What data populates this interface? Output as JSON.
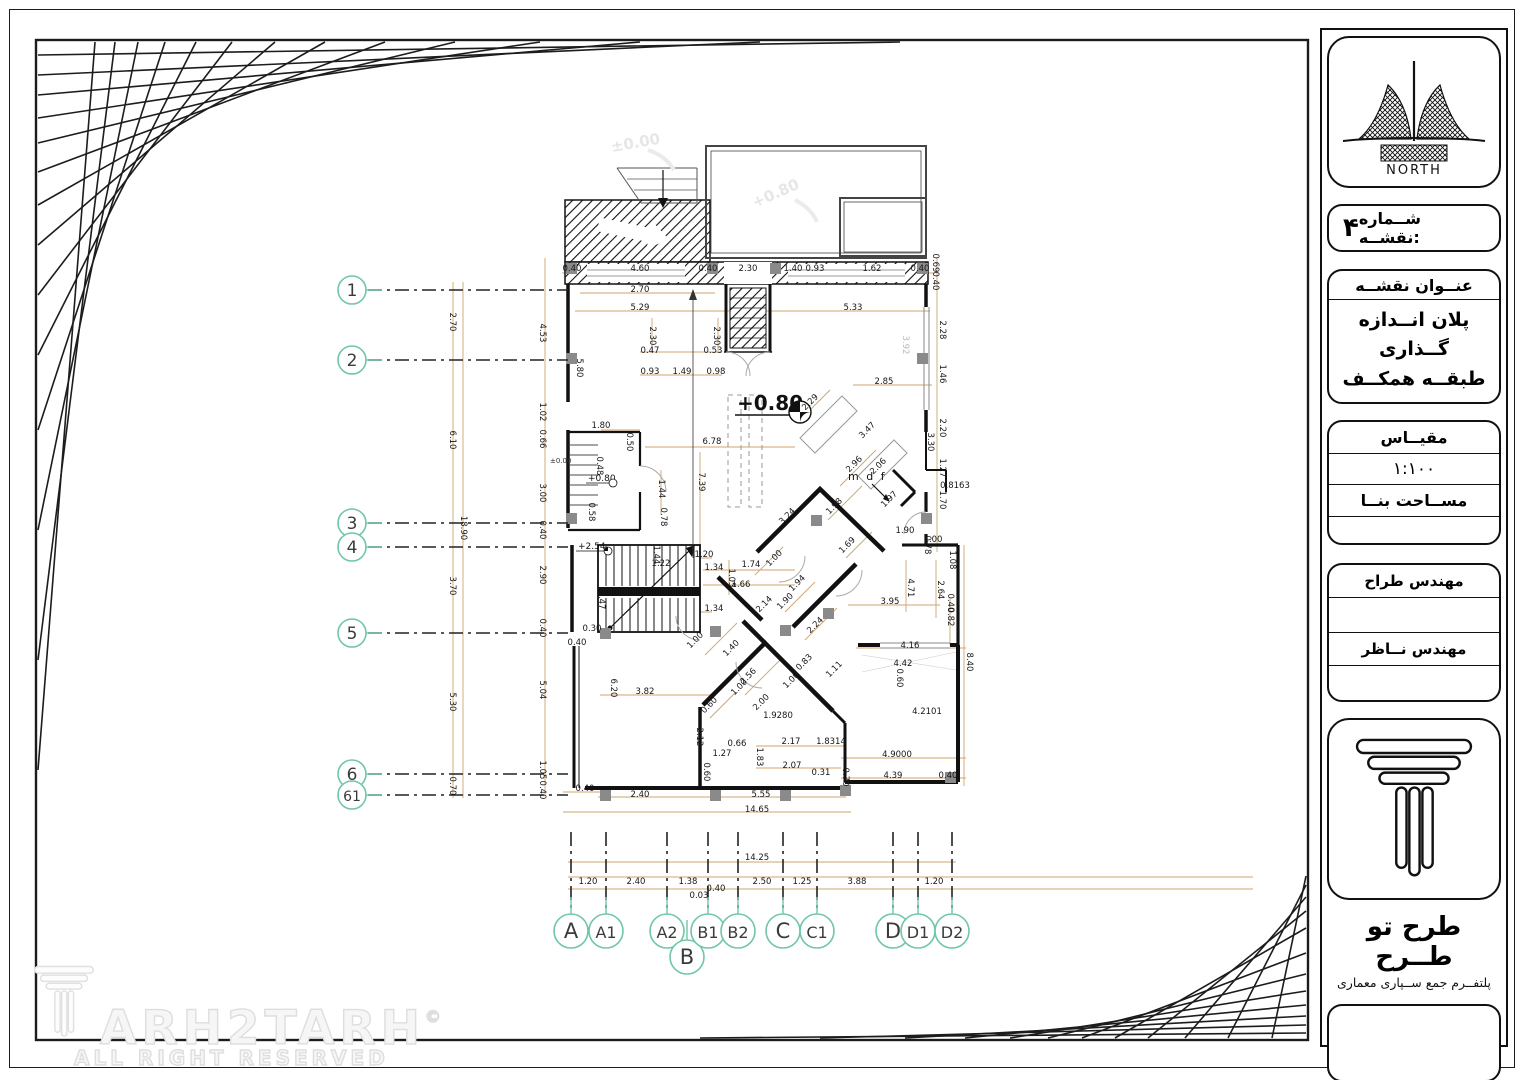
{
  "colors": {
    "accent_teal": "#6fc7a5",
    "dimension_tan": "#cfa572",
    "column_gray": "#8a8a8a",
    "wall_black": "#111111",
    "faint_gray": "#e6e6e6"
  },
  "title_block": {
    "north_label": "NORTH",
    "sheet_number_label": "شــماره نقشــه:",
    "sheet_number_value": "۴",
    "map_title_label": "عنــوان نقشــه",
    "map_title_line1": "پلان انــدازه گــذاری",
    "map_title_line2": "طبقــه همکــف",
    "scale_label": "مقیــاس",
    "scale_value": "۱:۱۰۰",
    "area_label": "مســاحت بنــا",
    "designer_label": "مهندس  طراح",
    "supervisor_label": "مهندس نــاظر",
    "brand_name": "طرح تو طــرح",
    "brand_subtitle": "پلتفــرم جمع ســپاری معماری"
  },
  "watermark": {
    "logo_text": "ARH2TARH",
    "copyright": "©",
    "rights": "ALL RIGHT RESERVED"
  },
  "plan": {
    "levels": {
      "main": "+0.80",
      "stair": "+2.54",
      "wc": "+0.80",
      "zero": "±0.00",
      "faint_top_left": "±0.00",
      "faint_top_right": "+0.80"
    },
    "labels": {
      "mdf": "m d f"
    },
    "left_axes": [
      {
        "label": "1",
        "y": 290
      },
      {
        "label": "2",
        "y": 360
      },
      {
        "label": "3",
        "y": 523
      },
      {
        "label": "4",
        "y": 547
      },
      {
        "label": "5",
        "y": 633
      },
      {
        "label": "6",
        "y": 774
      },
      {
        "label": "61",
        "y": 795
      }
    ],
    "bottom_axes": [
      {
        "label": "A",
        "x": 571
      },
      {
        "label": "A1",
        "x": 606
      },
      {
        "label": "A2",
        "x": 667
      },
      {
        "label": "B",
        "x": 687,
        "drop": true
      },
      {
        "label": "B1",
        "x": 708
      },
      {
        "label": "B2",
        "x": 738
      },
      {
        "label": "C",
        "x": 783
      },
      {
        "label": "C1",
        "x": 817
      },
      {
        "label": "D",
        "x": 893
      },
      {
        "label": "D1",
        "x": 918
      },
      {
        "label": "D2",
        "x": 952
      }
    ],
    "dimensions": [
      [
        "0.40",
        572,
        271
      ],
      [
        "4.60",
        640,
        271
      ],
      [
        "0.40",
        708,
        271
      ],
      [
        "2.30",
        748,
        271
      ],
      [
        "1.40",
        793,
        271
      ],
      [
        "0.93",
        815,
        271
      ],
      [
        "1.62",
        872,
        271
      ],
      [
        "0.40",
        920,
        271
      ],
      [
        "0.69",
        933,
        263,
        90
      ],
      [
        "0.40",
        933,
        281,
        90
      ],
      [
        "2.70",
        640,
        292
      ],
      [
        "5.29",
        640,
        310
      ],
      [
        "5.33",
        853,
        310
      ],
      [
        "2.30",
        650,
        336,
        90
      ],
      [
        "2.30",
        714,
        336,
        90
      ],
      [
        "0.47",
        650,
        353
      ],
      [
        "0.53",
        713,
        353
      ],
      [
        "0.93",
        650,
        374
      ],
      [
        "1.49",
        682,
        374
      ],
      [
        "0.98",
        716,
        374
      ],
      [
        "2.70",
        450,
        322,
        90
      ],
      [
        "6.10",
        450,
        440,
        90
      ],
      [
        "18.90",
        461,
        528,
        90
      ],
      [
        "3.70",
        450,
        586,
        90
      ],
      [
        "5.30",
        450,
        702,
        90
      ],
      [
        "0.70",
        450,
        786,
        90
      ],
      [
        "4.53",
        540,
        333,
        90
      ],
      [
        "1.02",
        540,
        412,
        90
      ],
      [
        "0.66",
        540,
        439,
        90
      ],
      [
        "3.00",
        540,
        493,
        90
      ],
      [
        "0.40",
        540,
        530,
        90
      ],
      [
        "2.90",
        540,
        575,
        90
      ],
      [
        "0.40",
        540,
        628,
        90
      ],
      [
        "5.04",
        540,
        690,
        90
      ],
      [
        "1.05",
        540,
        770,
        90
      ],
      [
        "0.40",
        540,
        790,
        90
      ],
      [
        "5.80",
        577,
        368,
        90
      ],
      [
        "1.80",
        601,
        428
      ],
      [
        "0.50",
        627,
        442,
        90
      ],
      [
        "0.48",
        597,
        466,
        90
      ],
      [
        "1.44",
        659,
        489,
        90
      ],
      [
        "0.58",
        589,
        512,
        90
      ],
      [
        "0.78",
        661,
        517,
        90
      ],
      [
        "2.28",
        940,
        330,
        90
      ],
      [
        "1.46",
        940,
        374,
        90
      ],
      [
        "2.20",
        940,
        428,
        90
      ],
      [
        "3.30",
        928,
        442,
        90
      ],
      [
        "1.27",
        940,
        468,
        90
      ],
      [
        "1.70",
        940,
        500,
        90
      ],
      [
        "0.78",
        925,
        545,
        90
      ],
      [
        "1.90",
        905,
        533
      ],
      [
        "1.00",
        933,
        542
      ],
      [
        "1.08",
        950,
        560,
        90
      ],
      [
        "0.8163",
        955,
        488
      ],
      [
        "2.85",
        884,
        384
      ],
      [
        "3.92",
        903,
        345,
        90,
        "g"
      ],
      [
        "4.71",
        908,
        588,
        90
      ],
      [
        "2.64",
        938,
        590,
        90
      ],
      [
        "3.95",
        890,
        604
      ],
      [
        "4.16",
        910,
        648
      ],
      [
        "0.82",
        948,
        617,
        90
      ],
      [
        "0.40",
        948,
        603,
        90
      ],
      [
        "8.40",
        967,
        662,
        90
      ],
      [
        "4.2101",
        927,
        714
      ],
      [
        "4.9000",
        897,
        757
      ],
      [
        "4.39",
        893,
        778
      ],
      [
        "0.40",
        948,
        778
      ],
      [
        "0.70",
        843,
        777,
        90
      ],
      [
        "0.31",
        821,
        775
      ],
      [
        "2.07",
        792,
        768
      ],
      [
        "1.8314",
        831,
        744
      ],
      [
        "2.17",
        791,
        744
      ],
      [
        "0.66",
        737,
        746
      ],
      [
        "1.27",
        722,
        756
      ],
      [
        "1.83",
        757,
        757,
        90
      ],
      [
        "1.9280",
        778,
        718
      ],
      [
        "6.78",
        712,
        444
      ],
      [
        "7.39",
        699,
        482,
        90
      ],
      [
        "2.29",
        812,
        404,
        -45
      ],
      [
        "3.47",
        869,
        432,
        -45
      ],
      [
        "2.96",
        856,
        466,
        -45
      ],
      [
        "2.06",
        880,
        468,
        -45
      ],
      [
        "1.98",
        836,
        508,
        -45
      ],
      [
        "1.97",
        891,
        501,
        -45
      ],
      [
        "3.24",
        789,
        518,
        -45
      ],
      [
        "1.69",
        849,
        547,
        -45
      ],
      [
        "1.20",
        704,
        557
      ],
      [
        "1.22",
        661,
        566
      ],
      [
        "1.44",
        654,
        555,
        90
      ],
      [
        "1.34",
        714,
        570
      ],
      [
        "1.74",
        751,
        567
      ],
      [
        "1.05",
        729,
        578,
        90
      ],
      [
        "1.00",
        776,
        560,
        -45
      ],
      [
        "1.66",
        741,
        587
      ],
      [
        "1.94",
        799,
        585,
        -45
      ],
      [
        "1.90",
        787,
        603,
        -45
      ],
      [
        "2.14",
        766,
        606,
        -45
      ],
      [
        "1.34",
        714,
        611
      ],
      [
        "1.47",
        599,
        600,
        90
      ],
      [
        "0.30",
        592,
        631
      ],
      [
        "0.40",
        577,
        645
      ],
      [
        "1.00",
        697,
        642,
        -45
      ],
      [
        "1.40",
        733,
        650,
        -45
      ],
      [
        "2.24",
        817,
        627,
        -45
      ],
      [
        "0.83",
        806,
        664,
        -45
      ],
      [
        "1.11",
        836,
        671,
        -45
      ],
      [
        "2.56",
        750,
        678,
        -45
      ],
      [
        "1.00",
        741,
        689,
        -45
      ],
      [
        "1.00",
        793,
        682,
        -45
      ],
      [
        "2.00",
        763,
        704,
        -45
      ],
      [
        "0.60",
        711,
        707,
        -45
      ],
      [
        "6.20",
        611,
        688,
        90
      ],
      [
        "3.82",
        645,
        694
      ],
      [
        "2.12",
        697,
        737,
        90
      ],
      [
        "0.60",
        704,
        772,
        90
      ],
      [
        "4.42",
        903,
        666
      ],
      [
        "0.60",
        897,
        678,
        90
      ],
      [
        "0.40",
        585,
        791
      ],
      [
        "2.40",
        640,
        797
      ],
      [
        "5.55",
        761,
        797
      ],
      [
        "14.65",
        757,
        812
      ],
      [
        "14.25",
        757,
        860
      ],
      [
        "1.20",
        588,
        884
      ],
      [
        "2.40",
        636,
        884
      ],
      [
        "1.38",
        688,
        884
      ],
      [
        "0.03",
        699,
        898
      ],
      [
        "0.40",
        716,
        891
      ],
      [
        "2.50",
        762,
        884
      ],
      [
        "1.25",
        802,
        884
      ],
      [
        "3.88",
        857,
        884
      ],
      [
        "1.20",
        934,
        884
      ]
    ]
  }
}
